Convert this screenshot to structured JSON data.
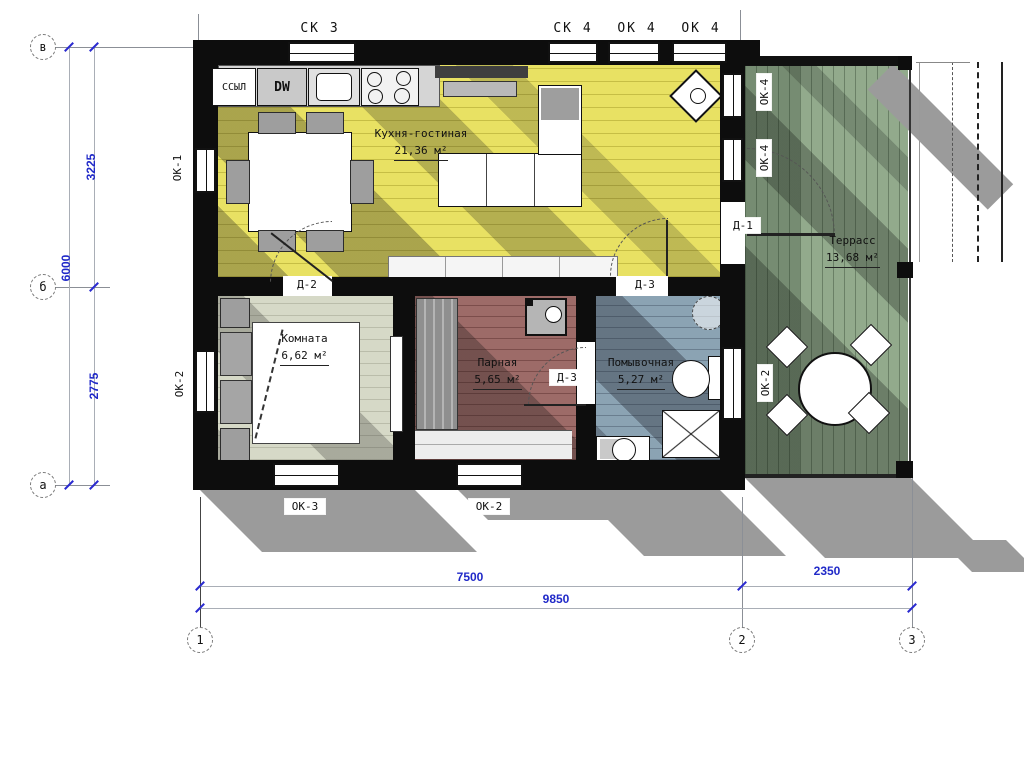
{
  "rooms": [
    {
      "name": "Кухня-гостиная",
      "area": "21,36 м²"
    },
    {
      "name": "Комната",
      "area": "6,62 м²"
    },
    {
      "name": "Парная",
      "area": "5,65 м²"
    },
    {
      "name": "Помывочная",
      "area": "5,27 м²"
    },
    {
      "name": "Террасс",
      "area": "13,68 м²"
    }
  ],
  "appliances": {
    "fridge": "ССЫЛ",
    "dishwasher": "DW"
  },
  "windows": {
    "top": [
      "СК 3",
      "СК 4",
      "ОК 4",
      "ОК 4"
    ],
    "left": [
      "ОК-1",
      "ОК-2"
    ],
    "right": [
      "ОК-4",
      "ОК-4",
      "ОК-2"
    ],
    "bottom": [
      "ОК-3",
      "ОК-2"
    ]
  },
  "doors": [
    "Д-1",
    "Д-2",
    "Д-3",
    "Д-3"
  ],
  "grid": {
    "rows": [
      "в",
      "б",
      "а"
    ],
    "cols": [
      "1",
      "2",
      "3"
    ]
  },
  "dims": {
    "v1": "3225",
    "v2": "2775",
    "v_total": "6000",
    "h1": "7500",
    "h2": "2350",
    "h_total": "9850"
  },
  "colors": {
    "wall": "#0d0d0d",
    "kitchen_floor": "#e8e163",
    "bedroom_floor": "#d6d9c7",
    "sauna_floor": "#9d6b68",
    "washroom_floor": "#8ba3b3",
    "terrace_floor": "#92aa8c",
    "dimension_blue": "#2029c8",
    "shadow_grey": "#9b9b9b"
  }
}
